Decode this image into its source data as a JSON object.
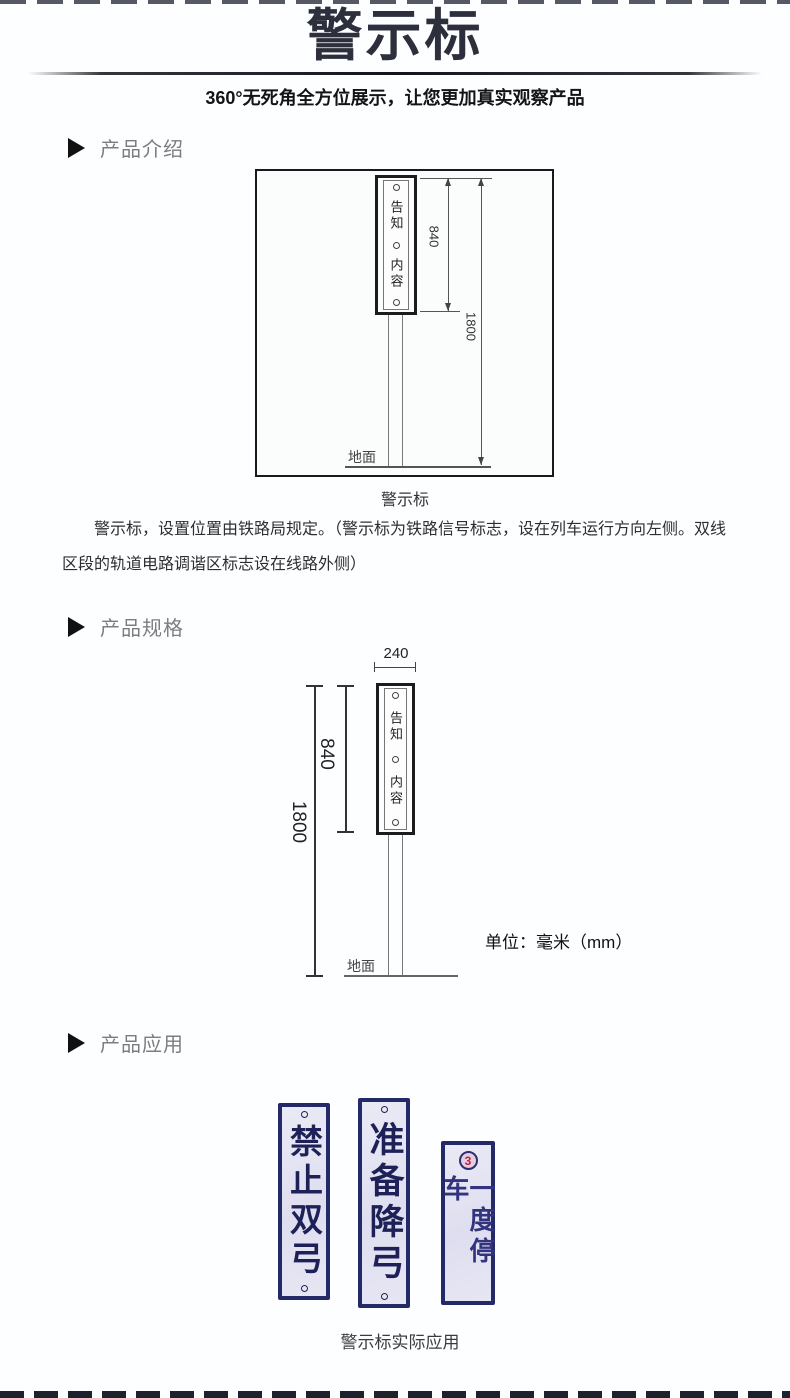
{
  "header": {
    "title": "警示标",
    "subtitle": "360°无死角全方位展示，让您更加真实观察产品"
  },
  "sections": {
    "intro": "产品介绍",
    "spec": "产品规格",
    "app": "产品应用"
  },
  "intro": {
    "caption": "警示标",
    "paragraph": "警示标，设置位置由铁路局规定。（警示标为铁路信号标志，设在列车运行方向左侧。双线区段的轨道电路调谐区标志设在线路外侧）"
  },
  "diagram1": {
    "panel_top": "告知",
    "panel_bottom": "内容",
    "dim_height": "840",
    "dim_total": "1800",
    "ground": "地面"
  },
  "diagram2": {
    "panel_top": "告知",
    "panel_bottom": "内容",
    "dim_width": "240",
    "dim_height": "840",
    "dim_total": "1800",
    "ground": "地面",
    "unit": "单位：毫米（mm）"
  },
  "app": {
    "caption": "警示标实际应用",
    "signs": [
      {
        "text": "禁止双弓"
      },
      {
        "text": "准备降弓"
      },
      {
        "text": "一度停车",
        "badge": "3"
      }
    ]
  },
  "colors": {
    "title_dark": "#2d303c",
    "heading_gray": "#7d7d7d",
    "sign_border": "#242a68",
    "sign_text": "#1e2158",
    "sign_bg": "#e3e3f1",
    "badge_red": "#c02240"
  }
}
